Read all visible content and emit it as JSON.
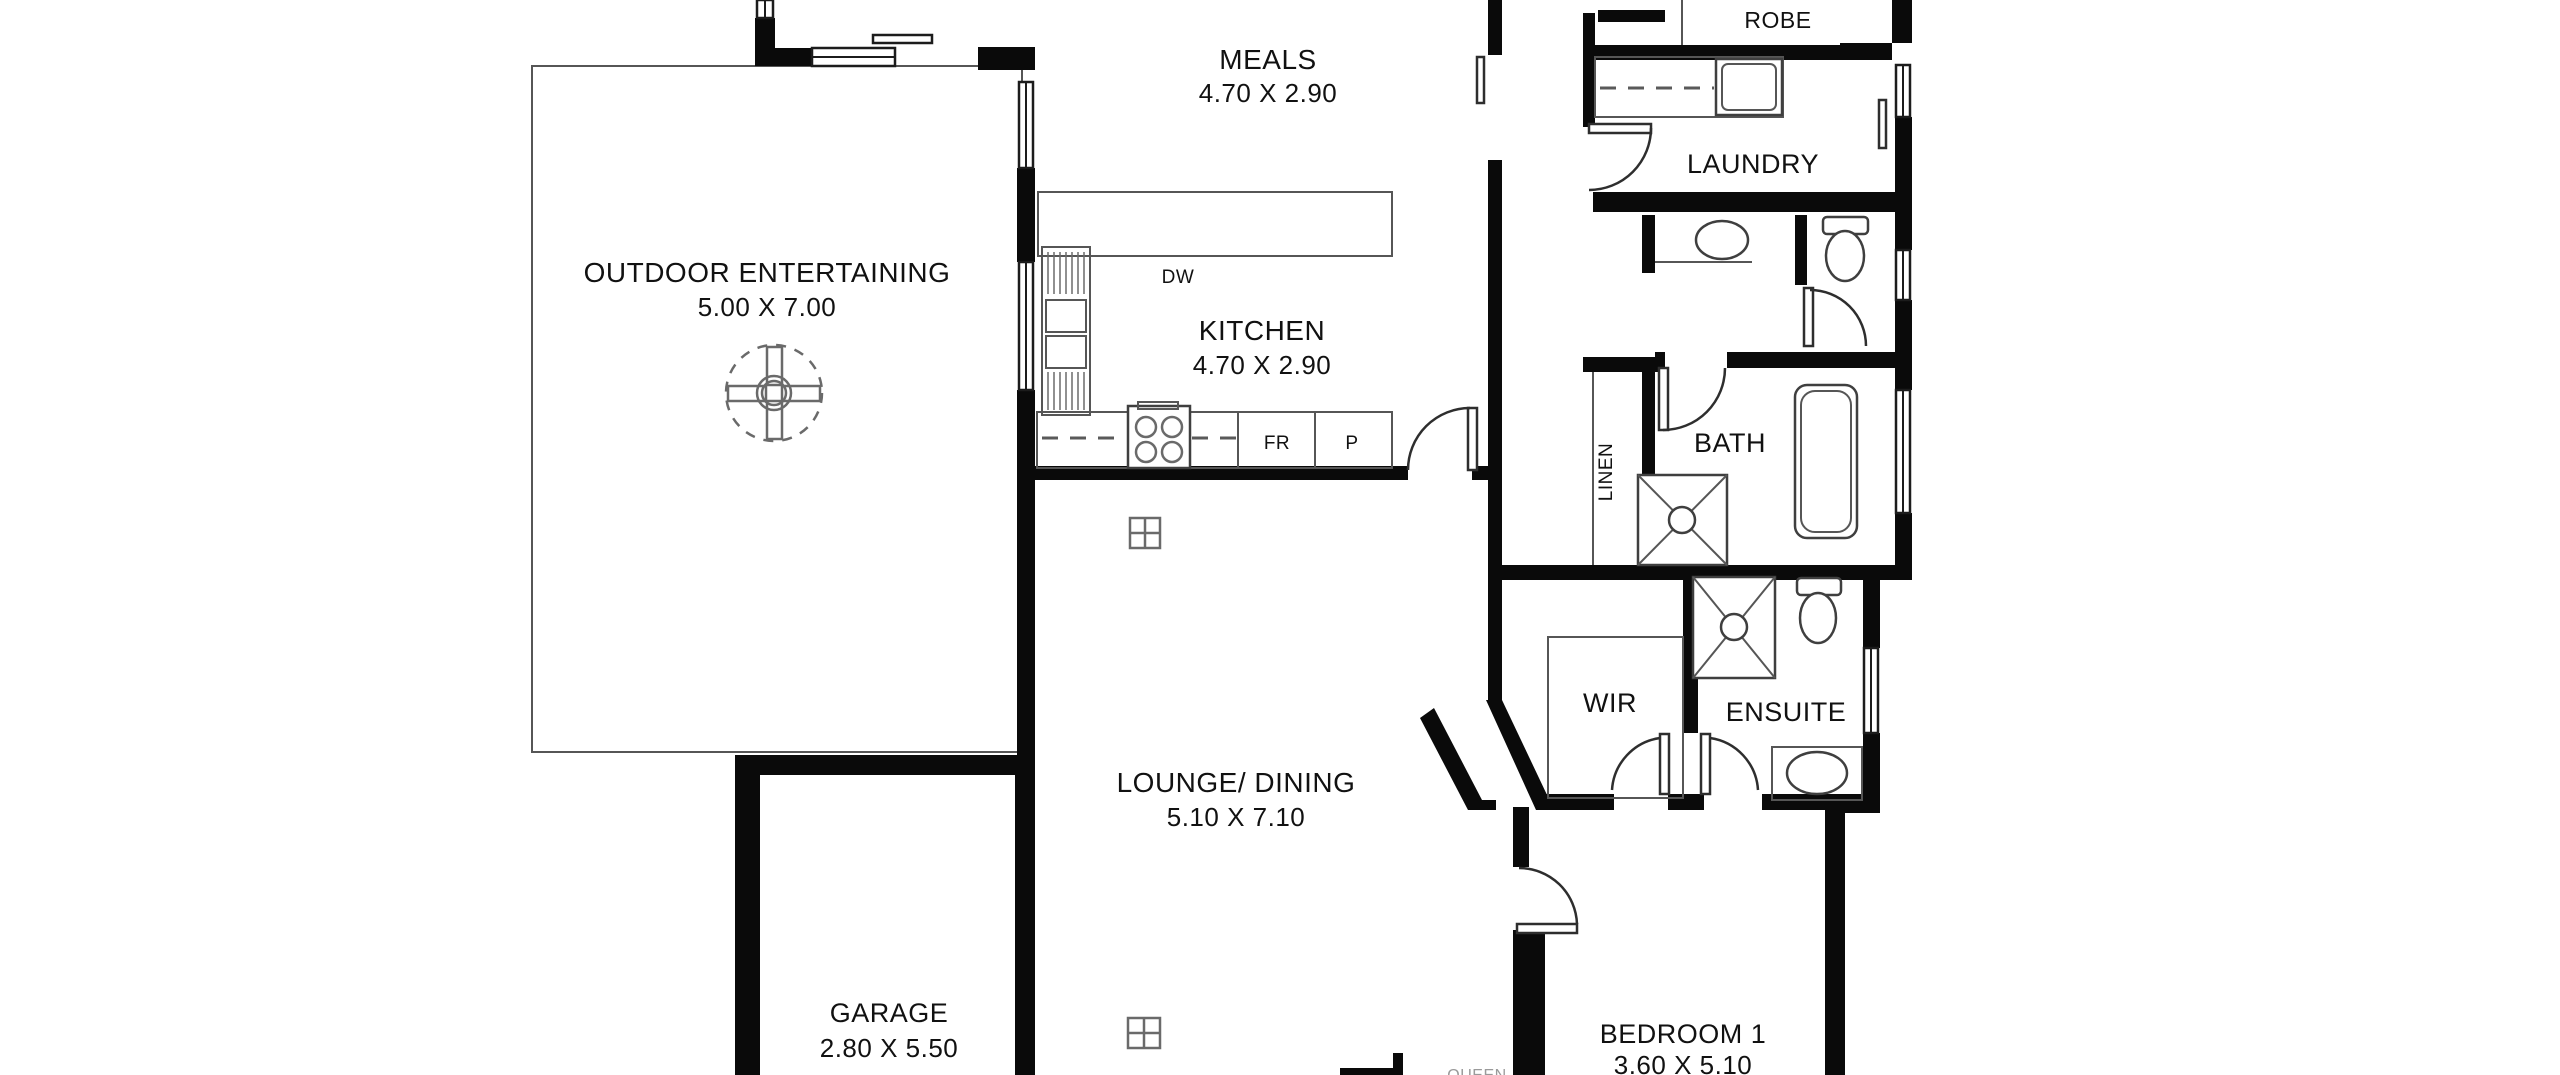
{
  "plan_type": "floor-plan",
  "rooms": {
    "outdoor": {
      "name": "OUTDOOR ENTERTAINING",
      "dims": "5.00 X 7.00"
    },
    "meals": {
      "name": "MEALS",
      "dims": "4.70 X 2.90"
    },
    "kitchen": {
      "name": "KITCHEN",
      "dims": "4.70 X 2.90"
    },
    "laundry": {
      "name": "LAUNDRY"
    },
    "robe": {
      "name": "ROBE"
    },
    "bath": {
      "name": "BATH"
    },
    "linen": {
      "name": "LINEN"
    },
    "wir": {
      "name": "WIR"
    },
    "ensuite": {
      "name": "ENSUITE"
    },
    "lounge": {
      "name": "LOUNGE/ DINING",
      "dims": "5.10 X 7.10"
    },
    "garage": {
      "name": "GARAGE",
      "dims": "2.80 X 5.50"
    },
    "bedroom1": {
      "name": "BEDROOM 1",
      "dims": "3.60 X 5.10"
    }
  },
  "appliance_labels": {
    "dishwasher": "DW",
    "fridge": "FR",
    "pantry": "P"
  },
  "furniture_labels": {
    "bed": "QUEEN"
  },
  "colors": {
    "wall": "#0a0a0a",
    "thin_line": "#565656",
    "text": "#111111",
    "background": "#ffffff"
  }
}
